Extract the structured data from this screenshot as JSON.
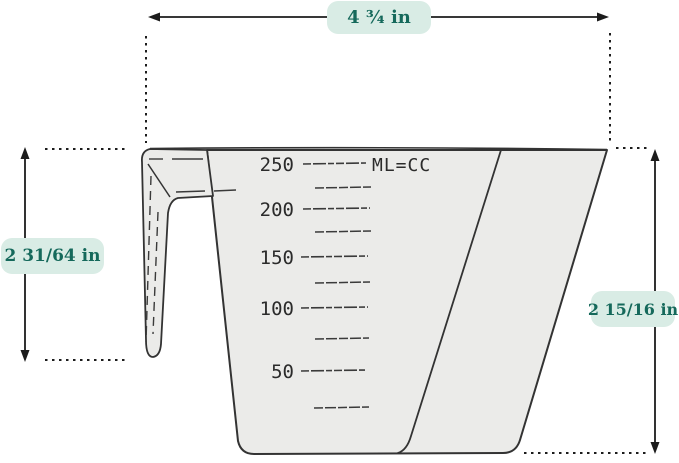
{
  "dimensions": {
    "top_width": {
      "label": "4 ¾ in"
    },
    "left_height": {
      "label": "2 31/64 in"
    },
    "right_height": {
      "label": "2 15/16 in"
    }
  },
  "cup": {
    "unit_label": "ML=CC",
    "scale_majors": [
      {
        "value": "250"
      },
      {
        "value": "200"
      },
      {
        "value": "150"
      },
      {
        "value": "100"
      },
      {
        "value": "50"
      }
    ],
    "minor_tick_count": 5
  },
  "colors": {
    "accent_text": "#15695b",
    "badge_bg": "#d9ece5",
    "outline": "#333333",
    "cup_fill": "#ebebe9",
    "dimension_line": "#1c1c1c"
  }
}
